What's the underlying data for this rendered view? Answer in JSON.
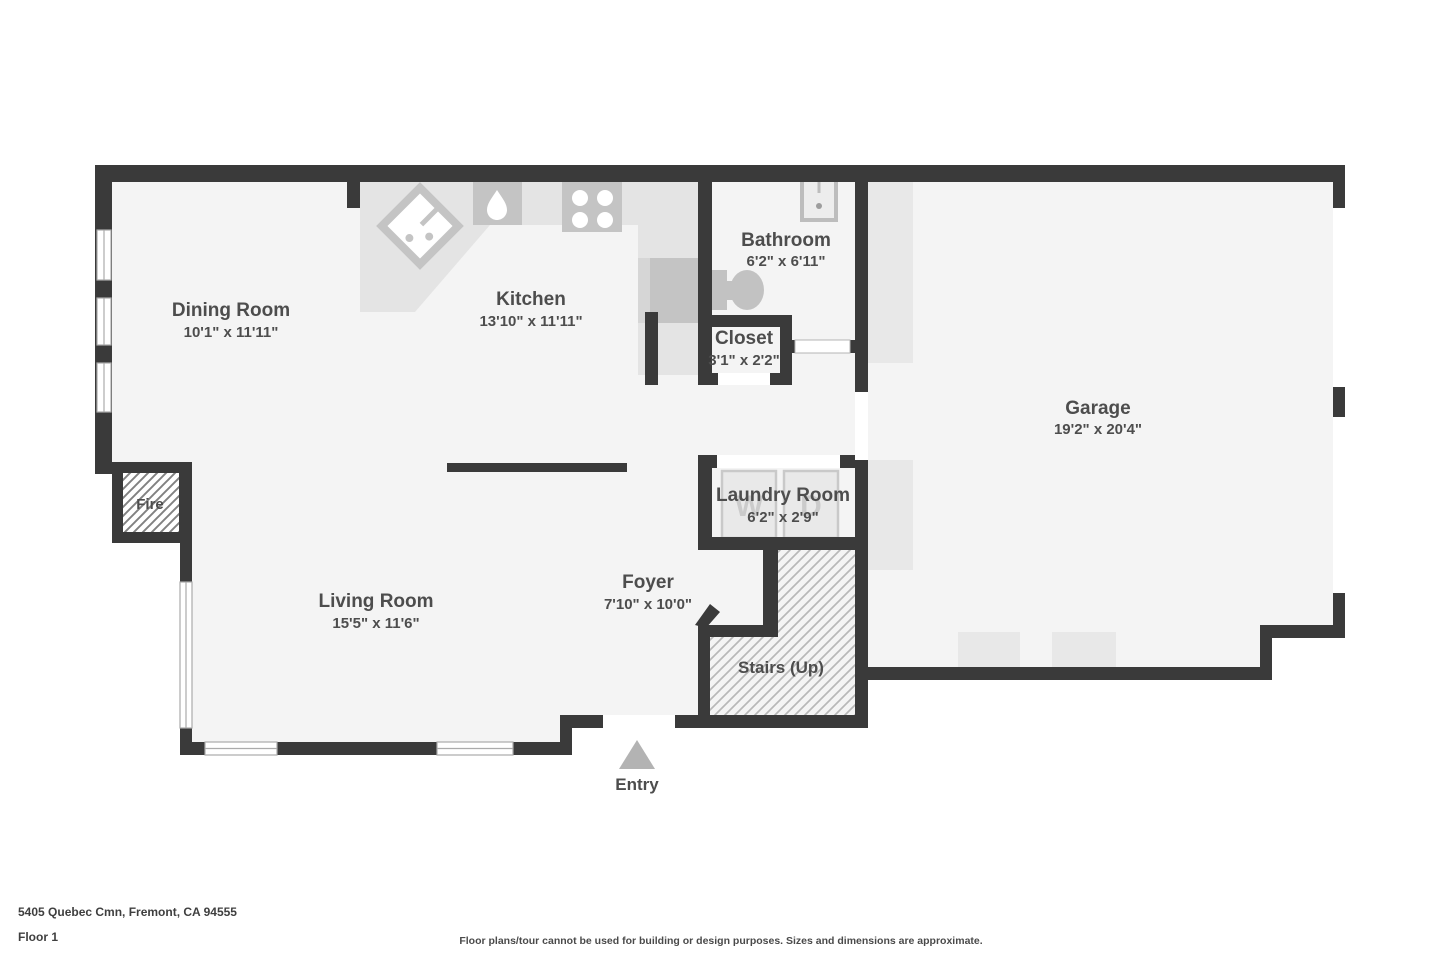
{
  "rooms": [
    {
      "id": "dining-room",
      "name": "Dining Room",
      "dims": "10'1\" x 11'11\""
    },
    {
      "id": "kitchen",
      "name": "Kitchen",
      "dims": "13'10\" x 11'11\""
    },
    {
      "id": "bathroom",
      "name": "Bathroom",
      "dims": "6'2\" x 6'11\""
    },
    {
      "id": "closet",
      "name": "Closet",
      "dims": "3'1\" x 2'2\""
    },
    {
      "id": "garage",
      "name": "Garage",
      "dims": "19'2\" x 20'4\""
    },
    {
      "id": "laundry-room",
      "name": "Laundry Room",
      "dims": "6'2\" x 2'9\""
    },
    {
      "id": "foyer",
      "name": "Foyer",
      "dims": "7'10\" x 10'0\""
    },
    {
      "id": "living-room",
      "name": "Living Room",
      "dims": "15'5\" x 11'6\""
    }
  ],
  "markers": {
    "fireplace": "Fire",
    "stairs": "Stairs (Up)",
    "entry": "Entry"
  },
  "appliance_letters": {
    "washer": "W",
    "dryer": "D"
  },
  "footer": {
    "address": "5405 Quebec Cmn, Fremont, CA 94555",
    "floor": "Floor 1",
    "disclaimer": "Floor plans/tour cannot be used for building or design purposes. Sizes and dimensions are approximate."
  },
  "colors": {
    "wall": "#3a3a3a",
    "floor": "#f4f4f4",
    "counter": "#e4e4e4",
    "appliance_dark": "#c4c4c4",
    "appliance_light": "#e9e9e9",
    "hatch_line": "#b5b5b5",
    "text": "#4d4d4d",
    "entry_arrow": "#b3b3b3"
  }
}
